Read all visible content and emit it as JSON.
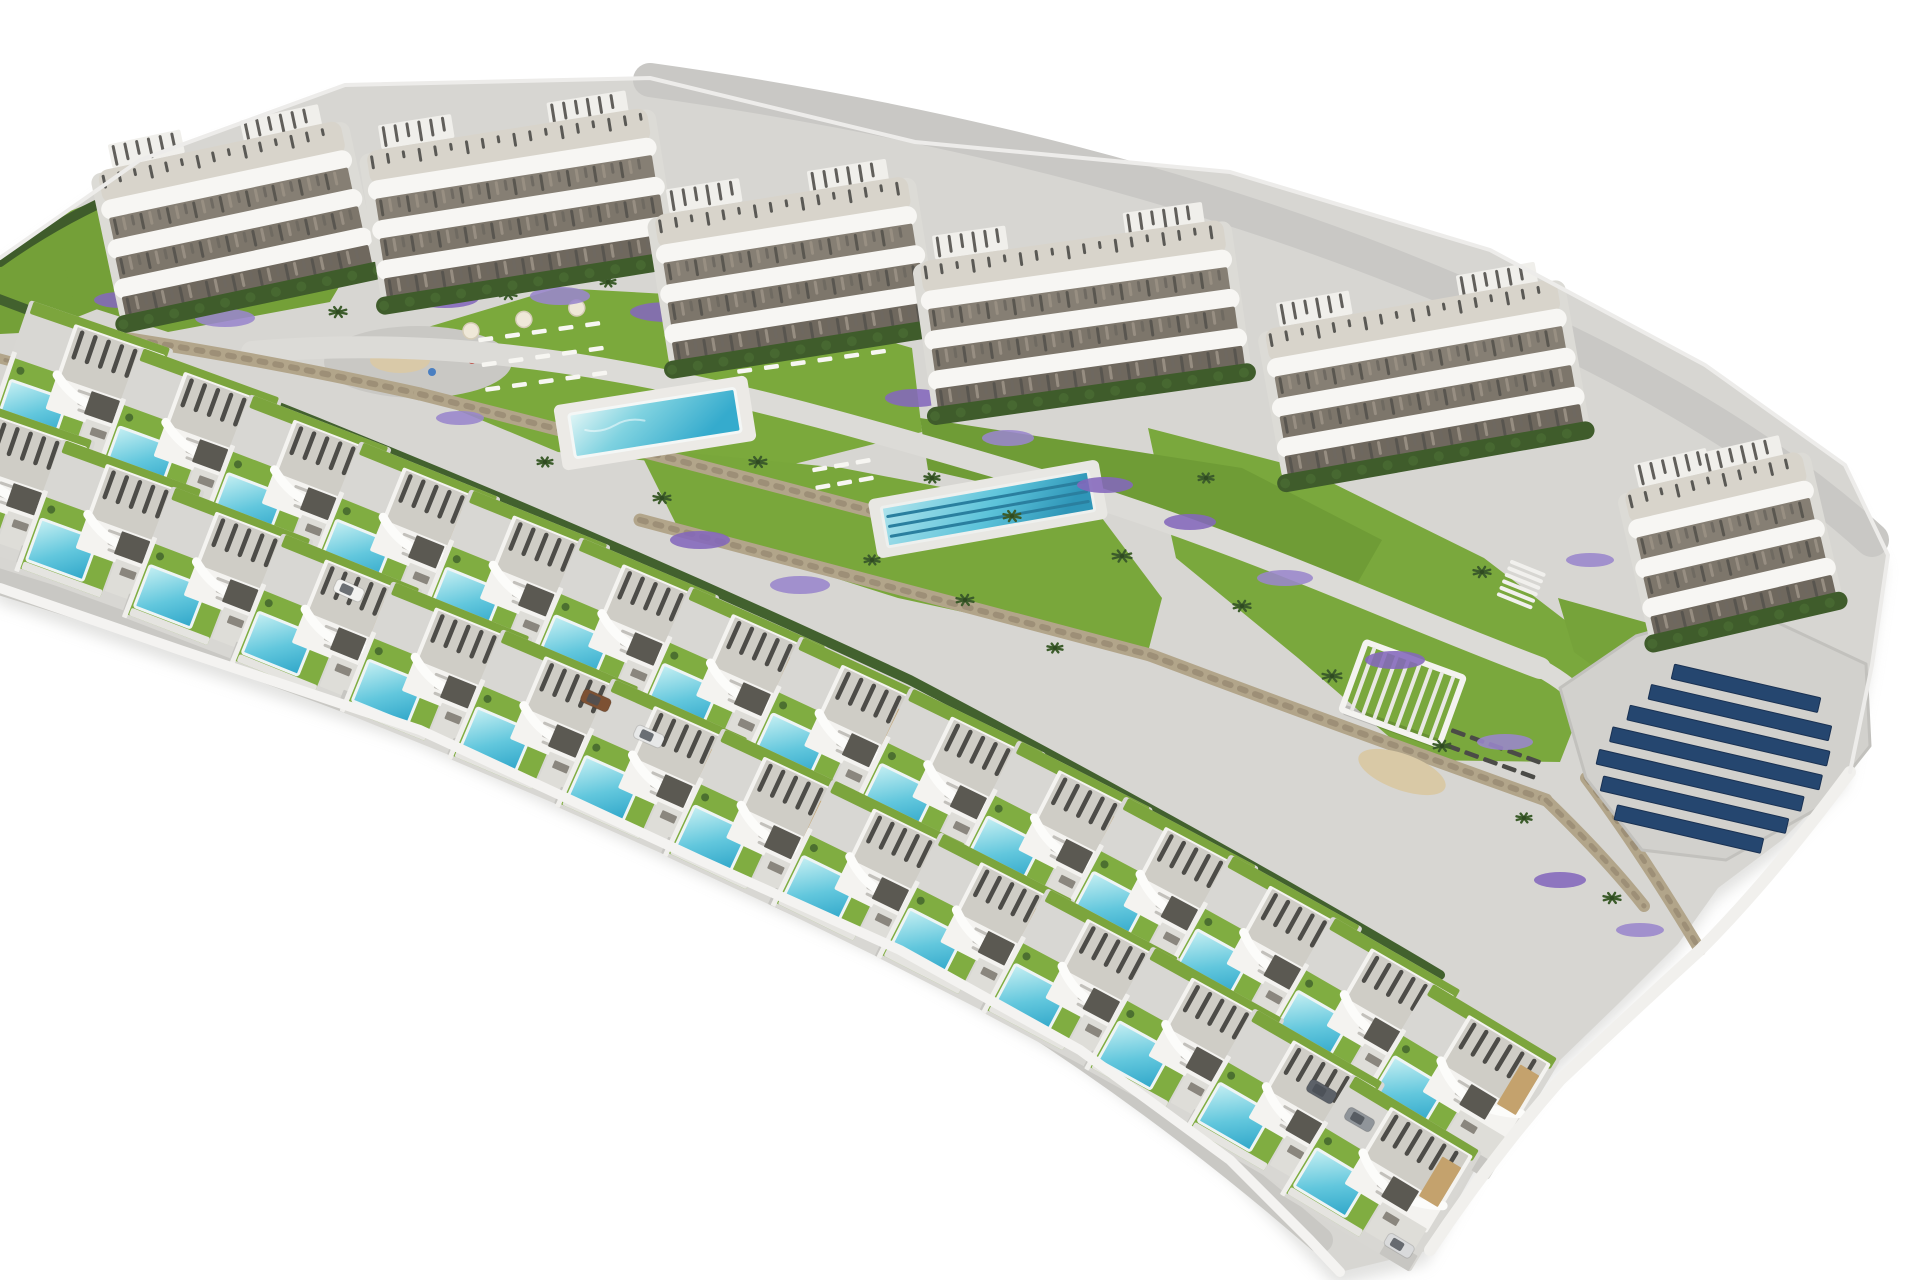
{
  "scene": {
    "description": "aerial-3d-render-residential-development-villas-and-apartments",
    "canvas": {
      "width": 1920,
      "height": 1280,
      "background": "#ffffff"
    },
    "palette": {
      "concrete": "#d7d6d2",
      "road": "#c9c8c5",
      "path": "#dcdbd7",
      "lawn": "#7ba93c",
      "hedge": "#3f5c2b",
      "stone_wall": "#b2a58a",
      "pool_light": "#c7f0f3",
      "pool_deep": "#2fa6c9",
      "roof": "#cfcdc6",
      "louver": "#4d4c48",
      "villa_wall": "#f4f3f0",
      "tan_accent": "#c4a26d",
      "solar_panel": "#25466f",
      "flowers": "#8468bc",
      "sand": "#d9c9a6",
      "shadow": "#cfcfcc"
    },
    "site_outline": "M0,258 L140,160 L345,85 L650,78 L915,142 L1230,172 L1490,250 L1705,365 L1845,465 L1888,555 L1872,665 L1850,772 L1782,840 L1718,888 L1678,944 L1618,1004 L1556,1064 L1478,1164 L1430,1250 L1340,1272 L1310,1240 L1230,1160 L1080,1050 L900,950 L700,860 L420,730 L180,650 L0,588 Z",
    "shapes": [
      {
        "type": "shadow",
        "name": "site-shadow",
        "d": "M0,258 L140,160 L345,85 L650,78 L915,142 L1230,172 L1490,250 L1705,365 L1845,465 L1888,555 L1872,665 L1850,772 L1782,840 L1718,888 L1678,944 L1618,1004 L1556,1064 L1478,1164 L1430,1250 L1340,1272 L1310,1240 L1230,1160 L1080,1050 L900,950 L700,860 L420,730 L180,650 L0,588 Z"
      },
      {
        "type": "path",
        "name": "site-base",
        "d": "M0,258 L140,160 L345,85 L650,78 L915,142 L1230,172 L1490,250 L1705,365 L1845,465 L1888,555 L1872,665 L1850,772 L1782,840 L1718,888 L1678,944 L1618,1004 L1556,1064 L1478,1164 L1430,1250 L1340,1272 L1310,1240 L1230,1160 L1080,1050 L900,950 L700,860 L420,730 L180,650 L0,588 Z",
        "fill": "#d7d6d2"
      },
      {
        "type": "path",
        "name": "perimeter-road",
        "d": "M650,80 Q1150,150 1520,320 Q1740,420 1872,540",
        "stroke": "#c9c8c5",
        "sw": 34
      },
      {
        "type": "path",
        "name": "lawn-top-left",
        "d": "M0,262 L60,215 L150,180 L125,298 L40,332 L0,334 Z",
        "fill": "#74a038"
      },
      {
        "type": "path",
        "name": "hedge-top-left",
        "d": "M0,262 Q70,212 150,182",
        "stroke": "#3f5c2b",
        "sw": 10
      },
      {
        "type": "path",
        "name": "lawn-block1",
        "d": "M60,250 L200,172 L348,132 L362,248 L330,302 L168,332 L74,302 Z",
        "fill": "#74a038"
      },
      {
        "type": "path",
        "name": "lawn-pool-garden",
        "d": "M418,330 L558,288 L740,298 L912,348 L922,432 L762,472 L558,452 L438,402 Z",
        "fill": "#7ba93c"
      },
      {
        "type": "path",
        "name": "lawn-lap-garden",
        "d": "M638,448 L842,468 L1102,518 L1162,598 L1148,652 L898,598 L678,528 Z",
        "fill": "#79a73b"
      },
      {
        "type": "path",
        "name": "lawn-right-slope",
        "d": "M1148,428 L1302,468 L1484,558 L1604,650 L1560,762 L1416,760 L1298,658 L1176,558 Z",
        "fill": "#7aa83d"
      },
      {
        "type": "path",
        "name": "lawn-block5-front",
        "d": "M920,418 L1242,468 L1382,540 L1358,582 L1146,520 L928,470 Z",
        "fill": "#6f9c36"
      },
      {
        "type": "path",
        "name": "lawn-block6",
        "d": "M1558,598 L1702,638 L1762,700 L1642,702 L1574,652 Z",
        "fill": "#76a33a"
      },
      {
        "type": "playground",
        "name": "playground-plaza",
        "cx": 418,
        "cy": 362,
        "rx": 94,
        "ry": 36
      },
      {
        "type": "path",
        "name": "garden-path",
        "d": "M252,352 C520,328 760,398 1000,468 S1380,608 1540,668",
        "stroke": "#dcdbd7",
        "sw": 22
      },
      {
        "type": "path",
        "name": "garden-path-right",
        "d": "M1540,668 Q1602,702 1622,762",
        "stroke": "#dcdbd7",
        "sw": 18
      },
      {
        "type": "wall",
        "name": "stone-wall-1",
        "d": "M70,330 Q250,356 420,394",
        "sw": 13
      },
      {
        "type": "wall",
        "name": "stone-wall-2",
        "d": "M420,394 Q640,450 905,520",
        "sw": 13
      },
      {
        "type": "wall",
        "name": "stone-wall-3",
        "d": "M640,520 Q900,590 1150,655",
        "sw": 13
      },
      {
        "type": "wall",
        "name": "stone-wall-4",
        "d": "M1150,655 Q1350,730 1546,800",
        "sw": 13
      },
      {
        "type": "wall",
        "name": "stone-wall-5",
        "d": "M1546,800 Q1606,858 1644,906",
        "sw": 12
      },
      {
        "type": "wall",
        "name": "stone-wall-6",
        "d": "M1586,778 Q1640,850 1700,950",
        "sw": 12
      },
      {
        "type": "wall",
        "name": "stone-wall-villas",
        "d": "M-10,356 Q430,470 890,690 Q1160,830 1360,990",
        "sw": 10
      },
      {
        "type": "pool",
        "name": "communal-pool",
        "cx": 655,
        "cy": 423,
        "w": 168,
        "h": 44,
        "rot": -9,
        "deckW": 196,
        "deckH": 66
      },
      {
        "type": "lap",
        "name": "lap-pool",
        "cx": 988,
        "cy": 509,
        "w": 210,
        "h": 40,
        "rot": -10,
        "lanes": 3,
        "deckW": 234,
        "deckH": 60
      },
      {
        "type": "loungers",
        "name": "sun-loungers-west",
        "x": 478,
        "y": 338,
        "rot": -8,
        "rows": 3,
        "cols": 5,
        "dx": 27,
        "dy": 25,
        "color": "#f7f6f2",
        "parasols": [
          [
            -6,
            -8
          ],
          [
            48,
            -12
          ],
          [
            102,
            -16
          ]
        ]
      },
      {
        "type": "loungers",
        "name": "sun-loungers-east",
        "x": 730,
        "y": 320,
        "rot": -8,
        "rows": 3,
        "cols": 6,
        "dx": 27,
        "dy": 25,
        "color": "#f7f6f2",
        "parasols": [
          [
            0,
            -10
          ],
          [
            54,
            -14
          ],
          [
            108,
            -10
          ]
        ]
      },
      {
        "type": "loungers",
        "name": "sun-loungers-lap",
        "x": 812,
        "y": 468,
        "rot": -10,
        "rows": 2,
        "cols": 3,
        "dx": 22,
        "dy": 18,
        "color": "#f7f6f2",
        "parasols": []
      },
      {
        "type": "loungers",
        "name": "sun-loungers-solar-lawn",
        "x": 1452,
        "y": 728,
        "rot": 20,
        "rows": 2,
        "cols": 5,
        "dx": 20,
        "dy": 16,
        "color": "#4b4b47",
        "parasols": []
      },
      {
        "type": "ellipse",
        "name": "petanque-sand",
        "cx": 1402,
        "cy": 772,
        "rx": 46,
        "ry": 18,
        "rot": 20,
        "fill": "#d9c9a6"
      },
      {
        "type": "pergola",
        "name": "garden-pergola",
        "x": 1366,
        "y": 642,
        "rot": 20,
        "w": 104,
        "h": 72
      },
      {
        "type": "slats",
        "name": "garden-stairs",
        "x": 1512,
        "y": 562,
        "rot": 22,
        "count": 6,
        "step": 7,
        "len": 34,
        "stroke": "#f1f0ed",
        "sw": 4
      },
      {
        "type": "solar",
        "name": "solar-panel-array",
        "pad": "M1560,688 L1636,636 L1742,606 L1866,664 L1870,746 L1822,806 L1726,860 L1642,850 L1586,778 Z",
        "x": 1622,
        "y": 652,
        "rot": 13,
        "rows": [
          [
            54,
            150
          ],
          [
            36,
            185
          ],
          [
            20,
            205
          ],
          [
            8,
            215
          ],
          [
            0,
            210
          ],
          [
            10,
            190
          ],
          [
            30,
            150
          ]
        ],
        "step": 25,
        "h": 15,
        "fill": "#25466f"
      },
      {
        "type": "flowers",
        "name": "flower-beds",
        "colors": [
          "#8468bc",
          "#9a86cc"
        ],
        "items": [
          [
            445,
            298,
            34,
            10
          ],
          [
            560,
            296,
            30,
            9
          ],
          [
            668,
            312,
            38,
            10
          ],
          [
            760,
            330,
            28,
            8
          ],
          [
            120,
            300,
            26,
            8
          ],
          [
            225,
            318,
            30,
            9
          ],
          [
            915,
            398,
            30,
            9
          ],
          [
            1008,
            438,
            26,
            8
          ],
          [
            1105,
            485,
            28,
            8
          ],
          [
            460,
            418,
            24,
            7
          ],
          [
            700,
            540,
            30,
            9
          ],
          [
            800,
            585,
            30,
            9
          ],
          [
            1190,
            522,
            26,
            8
          ],
          [
            1285,
            578,
            28,
            8
          ],
          [
            1395,
            660,
            30,
            9
          ],
          [
            1505,
            742,
            28,
            8
          ],
          [
            1560,
            880,
            26,
            8
          ],
          [
            1640,
            930,
            24,
            7
          ],
          [
            60,
            332,
            20,
            6
          ],
          [
            1590,
            560,
            24,
            7
          ]
        ]
      },
      {
        "type": "palms",
        "name": "palm-trees",
        "items": [
          [
            150,
            308,
            9
          ],
          [
            235,
            296,
            10
          ],
          [
            338,
            312,
            9
          ],
          [
            428,
            296,
            8
          ],
          [
            508,
            294,
            9
          ],
          [
            608,
            282,
            8
          ],
          [
            690,
            306,
            10
          ],
          [
            772,
            296,
            8
          ],
          [
            838,
            326,
            9
          ],
          [
            545,
            462,
            8
          ],
          [
            662,
            498,
            9
          ],
          [
            758,
            462,
            9
          ],
          [
            932,
            478,
            8
          ],
          [
            1012,
            516,
            9
          ],
          [
            1122,
            556,
            10
          ],
          [
            1242,
            606,
            9
          ],
          [
            1332,
            676,
            10
          ],
          [
            1442,
            746,
            9
          ],
          [
            1524,
            818,
            8
          ],
          [
            1612,
            898,
            9
          ],
          [
            1206,
            478,
            8
          ],
          [
            1482,
            572,
            9
          ],
          [
            872,
            560,
            8
          ],
          [
            965,
            600,
            9
          ],
          [
            1055,
            648,
            8
          ]
        ]
      },
      {
        "type": "path",
        "name": "hedge-villa-row",
        "d": "M-20,292 Q460,470 910,680 Q1210,838 1440,975",
        "stroke": "#42612e",
        "sw": 10
      },
      {
        "type": "path",
        "name": "villa-row-road-inner",
        "d": "M-60,468 Q420,610 870,820 Q1140,960 1400,1165",
        "stroke": "#c5c4c0",
        "sw": 24
      },
      {
        "type": "path",
        "name": "villa-row-road-outer",
        "d": "M-40,570 Q400,700 840,910 Q1090,1040 1320,1240",
        "stroke": "#c9c8c4",
        "sw": 26
      }
    ],
    "apartment_blocks": [
      {
        "x": 92,
        "y": 148,
        "w": 248,
        "rot": -12
      },
      {
        "x": 362,
        "y": 128,
        "w": 284,
        "rot": -9
      },
      {
        "x": 650,
        "y": 192,
        "w": 256,
        "rot": -9
      },
      {
        "x": 916,
        "y": 238,
        "w": 306,
        "rot": -8
      },
      {
        "x": 1260,
        "y": 306,
        "w": 296,
        "rot": -10
      },
      {
        "x": 1618,
        "y": 468,
        "w": 182,
        "rot": -13
      }
    ],
    "villas": {
      "row_back": [
        {
          "x": 30,
          "y": 300,
          "rot": 19
        },
        {
          "x": 140,
          "y": 347,
          "rot": 20
        },
        {
          "x": 250,
          "y": 394,
          "rot": 21
        },
        {
          "x": 360,
          "y": 441,
          "rot": 22
        },
        {
          "x": 470,
          "y": 489,
          "rot": 22
        },
        {
          "x": 580,
          "y": 537,
          "rot": 23
        },
        {
          "x": 690,
          "y": 586,
          "rot": 24
        },
        {
          "x": 800,
          "y": 636,
          "rot": 25
        },
        {
          "x": 910,
          "y": 687,
          "rot": 26
        },
        {
          "x": 1018,
          "y": 740,
          "rot": 27
        },
        {
          "x": 1125,
          "y": 796,
          "rot": 28
        },
        {
          "x": 1230,
          "y": 854,
          "rot": 29
        },
        {
          "x": 1332,
          "y": 916,
          "rot": 30
        },
        {
          "x": 1430,
          "y": 982,
          "rot": 31
        }
      ],
      "row_front": [
        {
          "x": -48,
          "y": 392,
          "rot": 19
        },
        {
          "x": 62,
          "y": 439,
          "rot": 20
        },
        {
          "x": 172,
          "y": 486,
          "rot": 21
        },
        {
          "x": 282,
          "y": 533,
          "rot": 22
        },
        {
          "x": 392,
          "y": 581,
          "rot": 22
        },
        {
          "x": 502,
          "y": 629,
          "rot": 23
        },
        {
          "x": 612,
          "y": 678,
          "rot": 24
        },
        {
          "x": 722,
          "y": 728,
          "rot": 25
        },
        {
          "x": 832,
          "y": 779,
          "rot": 26
        },
        {
          "x": 940,
          "y": 832,
          "rot": 27
        },
        {
          "x": 1047,
          "y": 888,
          "rot": 28
        },
        {
          "x": 1152,
          "y": 946,
          "rot": 29
        },
        {
          "x": 1254,
          "y": 1008,
          "rot": 30
        },
        {
          "x": 1352,
          "y": 1074,
          "rot": 31
        }
      ]
    },
    "cars": [
      {
        "x": 338,
        "y": 578,
        "rot": 24,
        "color": "#f2f2f0"
      },
      {
        "x": 585,
        "y": 688,
        "rot": 24,
        "color": "#7d5133"
      },
      {
        "x": 638,
        "y": 724,
        "rot": 24,
        "color": "#e7e8e8"
      },
      {
        "x": 1312,
        "y": 1078,
        "rot": 30,
        "color": "#5c6168"
      },
      {
        "x": 1350,
        "y": 1106,
        "rot": 30,
        "color": "#90959a"
      },
      {
        "x": 1390,
        "y": 1232,
        "rot": 31,
        "color": "#d9dadb"
      }
    ],
    "edge_highlights": [
      {
        "name": "site-edge-wall-bottom",
        "d": "M0,588 L180,650 L420,730 L700,860 L900,950 L1080,1050 L1230,1160 L1310,1240 L1340,1272",
        "stroke": "#f4f3f1",
        "sw": 10
      },
      {
        "name": "site-edge-wall-right",
        "d": "M1850,772 Q1770,880 1700,950 Q1630,1014 1560,1080 Q1490,1160 1430,1250",
        "stroke": "#f1f0ed",
        "sw": 12
      },
      {
        "name": "site-outline-highlight",
        "d": "M0,258 L140,160 L345,85 L650,78 L915,142 L1230,172 L1490,250 L1705,365 L1845,465 L1888,555 L1872,665 L1850,772",
        "stroke": "#edecea",
        "sw": 4
      }
    ]
  }
}
